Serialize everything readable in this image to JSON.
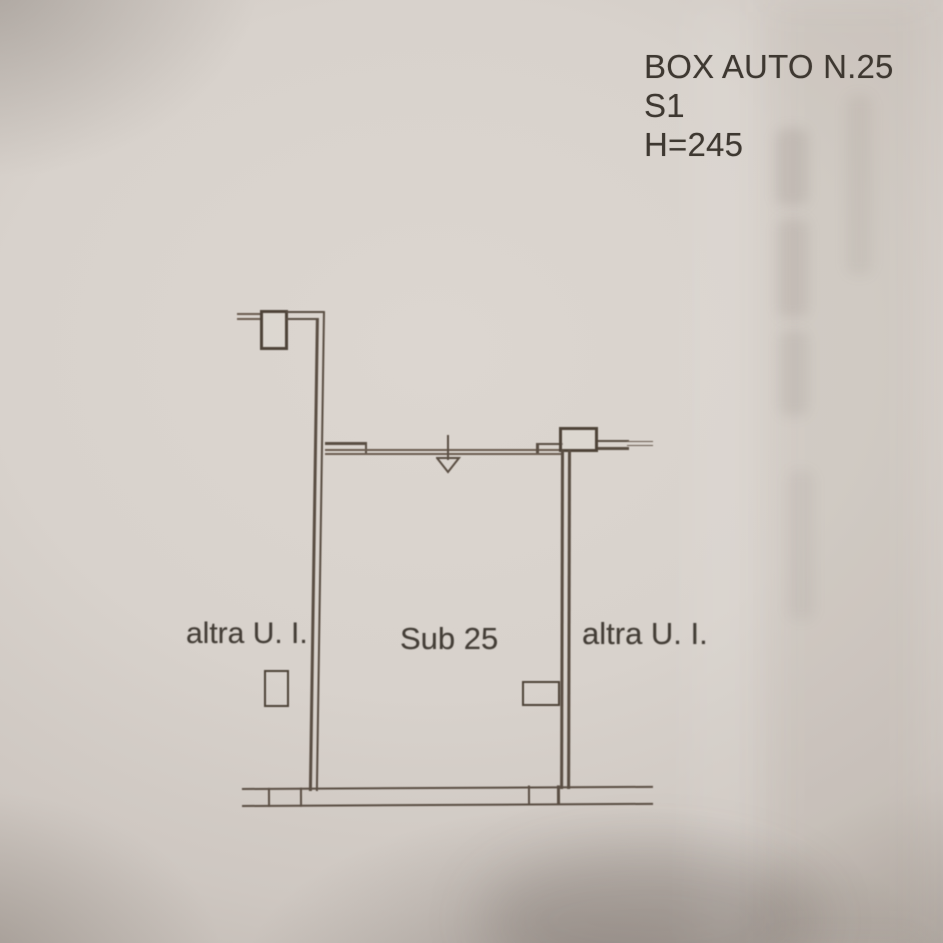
{
  "document": {
    "title_block": {
      "line1": "BOX AUTO N.25",
      "line2": "S1",
      "line3": "H=245"
    },
    "plan_labels": {
      "left_unit": "altra U. I.",
      "unit": "Sub 25",
      "right_unit": "altra U. I."
    },
    "colors": {
      "paper_light": "#dcd6d0",
      "paper_dark": "#a69d96",
      "ink_line": "#5a4e43",
      "ink_text": "#3e3831"
    }
  }
}
